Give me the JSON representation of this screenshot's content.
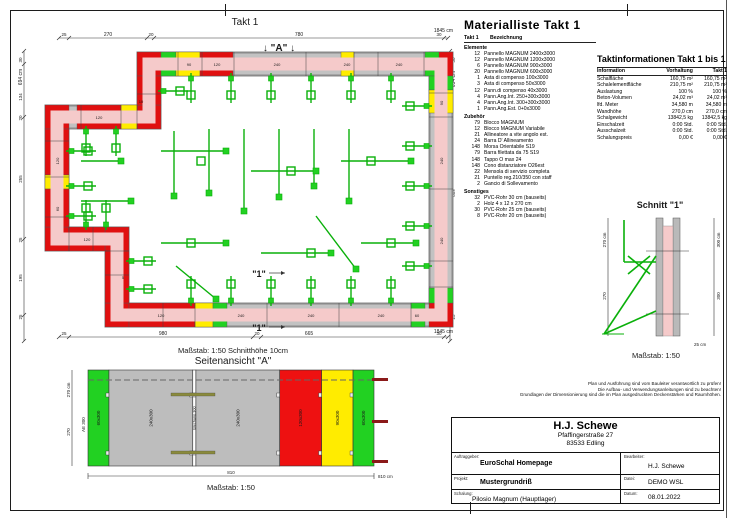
{
  "plan": {
    "title": "Takt 1",
    "marker_a": "↓ \"A\" ↓",
    "marker_1": "\"1\"",
    "masstab": "Maßstab: 1:50   Schnitthöhe 10cm",
    "dims": {
      "top": [
        "25",
        "270",
        "20",
        "780",
        "30",
        "1845 cm"
      ],
      "bottom": [
        "25",
        "980",
        "20",
        "665",
        "30",
        "1845 cm"
      ],
      "left": [
        "30",
        "694 cm",
        "134",
        "20",
        "255",
        "25",
        "195",
        "25"
      ],
      "right": [
        "30",
        "694 cm",
        "609",
        "25"
      ]
    },
    "panel_labels": {
      "p240": "240",
      "p120": "120",
      "p90": "90",
      "p60": "60",
      "comp10": "10",
      "comp5": "5"
    }
  },
  "material_list": {
    "title": "Materialliste  Takt 1",
    "col_takt": "Takt 1",
    "col_name": "Bezeichnung",
    "sections": [
      {
        "name": "Elemente",
        "items": [
          {
            "qty": "12",
            "label": "Pannello MAGNUM 2400x3000"
          },
          {
            "qty": "12",
            "label": "Pannello MAGNUM 1200x3000"
          },
          {
            "qty": "6",
            "label": "Pannello MAGNUM 900x3000"
          },
          {
            "qty": "20",
            "label": "Pannello MAGNUM 600x3000"
          },
          {
            "qty": "1",
            "label": "Asta di compenso 100x3000"
          },
          {
            "qty": "3",
            "label": "Asta di compenso 50x3000"
          },
          {
            "qty": "12",
            "label": "Pann.di compenso 40x3000"
          },
          {
            "qty": "4",
            "label": "Pann.Ang.Int. 250+300x3000"
          },
          {
            "qty": "4",
            "label": "Pann.Ang.Int. 300+300x3000"
          },
          {
            "qty": "1",
            "label": "Pann.Ang.Est. 0+0x3000"
          }
        ]
      },
      {
        "name": "Zubehör",
        "items": [
          {
            "qty": "79",
            "label": "Blocco MAGNUM"
          },
          {
            "qty": "12",
            "label": "Blocco MAGNUM Variabile"
          },
          {
            "qty": "21",
            "label": "Allineatore a vite angolo est."
          },
          {
            "qty": "24",
            "label": "Barra D' Allineamento"
          },
          {
            "qty": "148",
            "label": "Morsa Orientabile S19"
          },
          {
            "qty": "79",
            "label": "Barra filettata da 75 S19"
          },
          {
            "qty": "148",
            "label": "Tappo O max 24"
          },
          {
            "qty": "148",
            "label": "Cono distanziatore O26est"
          },
          {
            "qty": "22",
            "label": "Mensola di servizio completa"
          },
          {
            "qty": "21",
            "label": "Puntello reg.210/350 con staff"
          },
          {
            "qty": "2",
            "label": "Gancio di Sollevamento"
          }
        ]
      },
      {
        "name": "Sonstiges",
        "items": [
          {
            "qty": "32",
            "label": "PVC-Rohr 30 cm (bauseits)"
          },
          {
            "qty": "2",
            "label": "Holz 4 x 12 x 270 cm"
          },
          {
            "qty": "30",
            "label": "PVC-Rohr 25 cm (bauseits)"
          },
          {
            "qty": "8",
            "label": "PVC-Rohr 20 cm (bauseits)"
          }
        ]
      }
    ]
  },
  "takt_info": {
    "title": "Taktinformationen  Takt 1 bis 1",
    "columns": [
      "Information",
      "Vorhaltung",
      "Takt 1"
    ],
    "rows": [
      {
        "label": "Schalfläche",
        "vorhaltung": "160,75 m²",
        "takt1": "160,75 m²"
      },
      {
        "label": "Schalelementfläche",
        "vorhaltung": "210,75 m²",
        "takt1": "210,75 m²"
      },
      {
        "label": "Auslastung",
        "vorhaltung": "100 %",
        "takt1": "100 %"
      },
      {
        "label": "Beton-Volumen",
        "vorhaltung": "24,02 m³",
        "takt1": "24,02 m³"
      },
      {
        "label": "lfd. Meter",
        "vorhaltung": "34,580 m",
        "takt1": "34,580 m"
      },
      {
        "label": "Wandhöhe",
        "vorhaltung": "270,0 cm",
        "takt1": "270,0 cm"
      },
      {
        "label": "Schalgewicht",
        "vorhaltung": "13842,5 kg",
        "takt1": "13842,5 kg"
      },
      {
        "label": "Einschalzeit",
        "vorhaltung": "0:00 Std.",
        "takt1": "0:00 Std."
      },
      {
        "label": "Ausschalzeit",
        "vorhaltung": "0:00 Std.",
        "takt1": "0:00 Std."
      },
      {
        "label": "Schalungspreis",
        "vorhaltung": "0,00 €",
        "takt1": "0,00 €"
      }
    ]
  },
  "schnitt": {
    "title": "Schnitt \"1\"",
    "dim_left_total": "270 cm",
    "dim_left": "270",
    "dim_right_total": "300 cm",
    "dim_right": "300",
    "dim_bottom": "25 cm",
    "masstab": "Maßstab: 1:50"
  },
  "side_view": {
    "title": "Seitenansicht \"A\"",
    "ae_label": "AE 300",
    "panels": [
      {
        "label": "60x300",
        "w": 60,
        "color": "#22d122"
      },
      {
        "label": "240x300",
        "w": 240,
        "color": "#bdbdbd"
      },
      {
        "label": "Blechanp.300",
        "w": 9,
        "color": "#ffffff"
      },
      {
        "label": "240x300",
        "w": 240,
        "color": "#bdbdbd"
      },
      {
        "label": "120x300",
        "w": 120,
        "color": "#ee1111"
      },
      {
        "label": "90x300",
        "w": 90,
        "color": "#ffec00"
      },
      {
        "label": "60x300",
        "w": 60,
        "color": "#22d122"
      }
    ],
    "dim_height_total": "270 cm",
    "dim_height": "270",
    "dim_width": "810",
    "dim_width_total": "810 cm",
    "masstab": "Maßstab: 1:50"
  },
  "fine_print": {
    "line1": "Plan und Ausführung sind vom Bauleiter verantwortlich zu prüfen!",
    "line2": "Die Aufbau- und Verwendungsanleitungen sind zu beachten!",
    "line3": "Grundlagen der Dimensionierung sind die im Plan ausgedruckten Deckenstärken und Raumhöhen."
  },
  "title_block": {
    "company": "H.J. Schewe",
    "street": "Pfaffingerstraße 27",
    "city": "83533 Edling",
    "cap_auftraggeber": "Auftraggeber:",
    "cap_bearbeiter": "Bearbeiter:",
    "cap_projekt": "Projekt:",
    "cap_datei": "Datei:",
    "cap_schalung": "Schalung:",
    "cap_datum": "Datum:",
    "auftraggeber": "EuroSchal Homepage",
    "bearbeiter": "H.J. Schewe",
    "projekt": "Mustergrundriß",
    "datei": "DEMO WSL",
    "schalung": "Pilosio Magnum (Hauptlager)",
    "datum": "08.01.2022"
  },
  "colors": {
    "wall_pink": "#f5caca",
    "panel_gray": "#c2c2c2",
    "red": "#e01010",
    "yellow": "#ffec00",
    "green": "#22d122",
    "hw_green": "#0ab00a"
  }
}
